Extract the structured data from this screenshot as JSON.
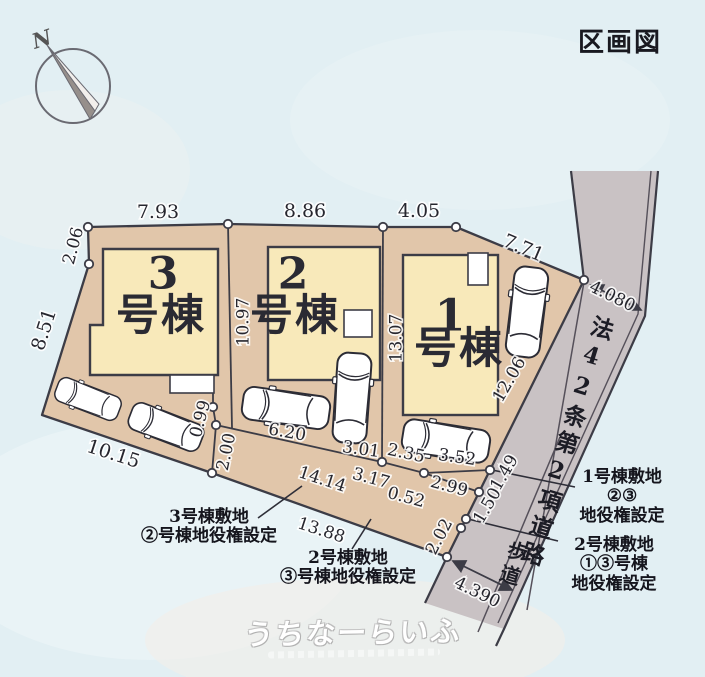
{
  "header": {
    "title": "区画図"
  },
  "compass": {
    "north": "N"
  },
  "colors": {
    "bg": "#e2eff3",
    "plot": "#e1c6aa",
    "building": "#f8e9ba",
    "road": "#c9c2c4",
    "line": "#3c3c46",
    "ink": "#23232c"
  },
  "buildings": [
    {
      "num": "3",
      "name": "号棟"
    },
    {
      "num": "2",
      "name": "号棟"
    },
    {
      "num": "1",
      "name": "号棟"
    }
  ],
  "road": {
    "label": "法42条第2項道路",
    "sidewalk": "歩道"
  },
  "dims": [
    "7.93",
    "8.86",
    "4.05",
    "7.71",
    "2.06",
    "8.51",
    "10.97",
    "13.07",
    "12.06",
    "4.080",
    "10.15",
    "0.99",
    "2.00",
    "6.20",
    "3.01",
    "2.35",
    "3.52",
    "14.14",
    "3.17",
    "0.52",
    "2.99",
    "13.88",
    "1.49",
    "1.50",
    "2.02",
    "4.390"
  ],
  "notes": {
    "note1": {
      "lines": [
        "3号棟敷地",
        "②号棟地役権設定"
      ]
    },
    "note2": {
      "lines": [
        "2号棟敷地",
        "③号棟地役権設定"
      ]
    },
    "note3": {
      "lines": [
        "1号棟敷地",
        "②③",
        "地役権設定"
      ]
    },
    "note4": {
      "lines": [
        "2号棟敷地",
        "①③号棟",
        "地役権設定"
      ]
    }
  },
  "watermark": {
    "text": "うちなーらいふ"
  }
}
